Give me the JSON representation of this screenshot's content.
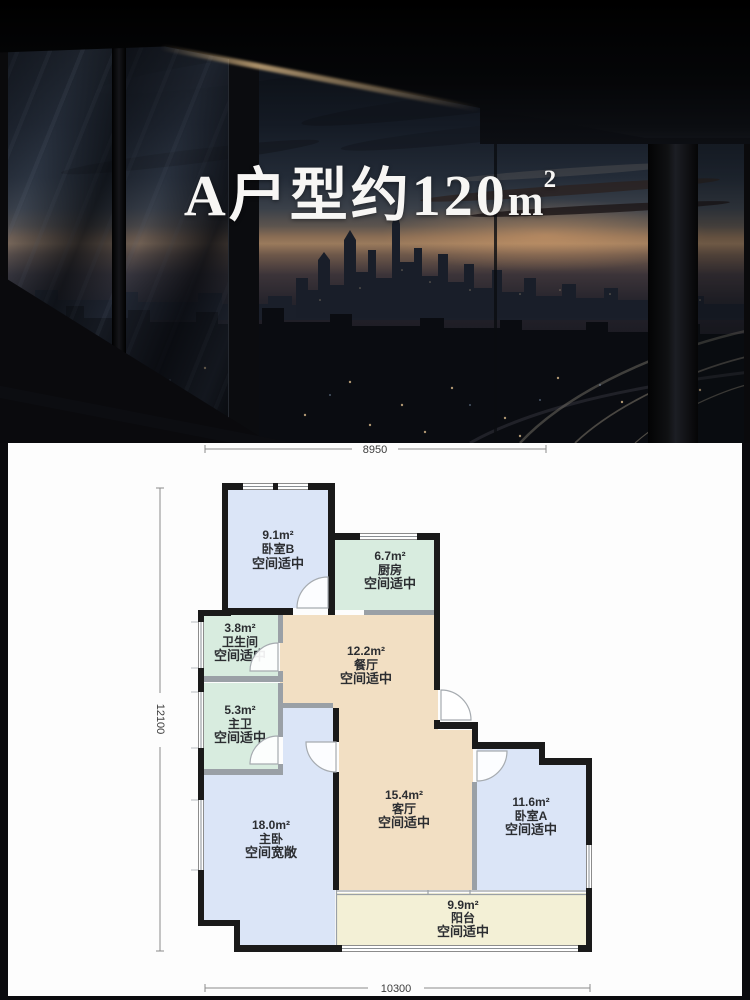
{
  "hero": {
    "title_main": "A户型约120",
    "unit": "m",
    "unit_sup": "2"
  },
  "plan": {
    "dim_top": "8950",
    "dim_left": "12100",
    "dim_bottom": "10300",
    "colors": {
      "bedroom": "#dbe5f7",
      "bath": "#d8ecdf",
      "hall": "#f2dfc3",
      "balcony": "#f3f0d6",
      "wall": "#1a1a1a"
    },
    "rooms": [
      {
        "id": "bedroom-b",
        "area": "9.1m²",
        "name": "卧室B",
        "note": "空间适中"
      },
      {
        "id": "kitchen",
        "area": "6.7m²",
        "name": "厨房",
        "note": "空间适中"
      },
      {
        "id": "bathroom",
        "area": "3.8m²",
        "name": "卫生间",
        "note": "空间适中"
      },
      {
        "id": "dining",
        "area": "12.2m²",
        "name": "餐厅",
        "note": "空间适中"
      },
      {
        "id": "master-bath",
        "area": "5.3m²",
        "name": "主卫",
        "note": "空间适中"
      },
      {
        "id": "living",
        "area": "15.4m²",
        "name": "客厅",
        "note": "空间适中"
      },
      {
        "id": "bedroom-a",
        "area": "11.6m²",
        "name": "卧室A",
        "note": "空间适中"
      },
      {
        "id": "master-bedroom",
        "area": "18.0m²",
        "name": "主卧",
        "note": "空间宽敞"
      },
      {
        "id": "balcony",
        "area": "9.9m²",
        "name": "阳台",
        "note": "空间适中"
      }
    ]
  }
}
